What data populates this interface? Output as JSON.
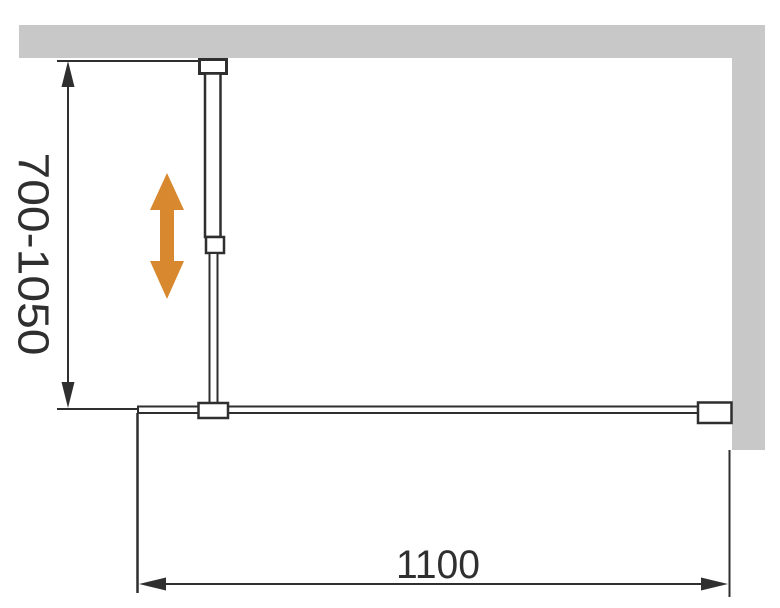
{
  "diagram": {
    "title": "shower-screen-dimension-diagram",
    "labels": {
      "height_range": "700-1050",
      "width": "1100"
    },
    "icons": {
      "adjustment_arrow": "vertical-double-arrow-icon",
      "dimension_arrows": "dimension-arrowhead-icon"
    },
    "colors": {
      "background": "#ffffff",
      "wall": "#c8c8c8",
      "line": "#2f2f2f",
      "arrow": "#d8882e"
    }
  }
}
